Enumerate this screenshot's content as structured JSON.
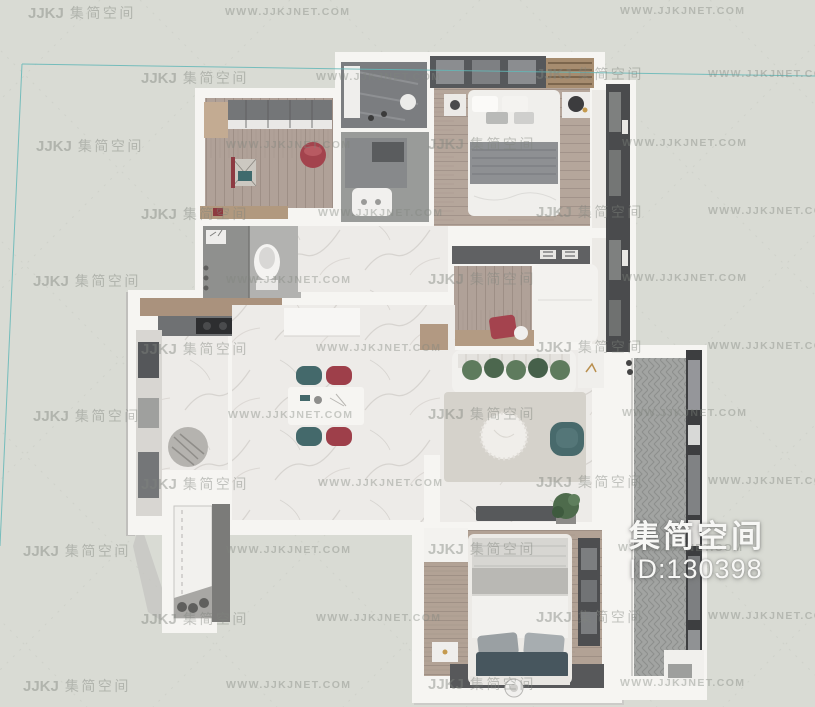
{
  "overlay": {
    "title": "集简空间",
    "id_label": "ID:130398"
  },
  "watermarks": {
    "logo": "JJKJ",
    "brand": "集简空间",
    "url": "WWW.JJKJNET.COM",
    "items": [
      {
        "type": "brand",
        "x": 28,
        "y": 3
      },
      {
        "type": "url",
        "x": 225,
        "y": 6
      },
      {
        "type": "url",
        "x": 620,
        "y": 5
      },
      {
        "type": "brand",
        "x": 141,
        "y": 68
      },
      {
        "type": "url",
        "x": 316,
        "y": 71
      },
      {
        "type": "brand",
        "x": 536,
        "y": 64
      },
      {
        "type": "url",
        "x": 708,
        "y": 68
      },
      {
        "type": "brand",
        "x": 36,
        "y": 136
      },
      {
        "type": "url",
        "x": 226,
        "y": 139
      },
      {
        "type": "brand",
        "x": 428,
        "y": 134
      },
      {
        "type": "url",
        "x": 622,
        "y": 137
      },
      {
        "type": "brand",
        "x": 141,
        "y": 204
      },
      {
        "type": "url",
        "x": 318,
        "y": 207
      },
      {
        "type": "brand",
        "x": 536,
        "y": 202
      },
      {
        "type": "url",
        "x": 708,
        "y": 205
      },
      {
        "type": "brand",
        "x": 33,
        "y": 271
      },
      {
        "type": "url",
        "x": 226,
        "y": 274
      },
      {
        "type": "brand",
        "x": 428,
        "y": 269
      },
      {
        "type": "url",
        "x": 622,
        "y": 272
      },
      {
        "type": "brand",
        "x": 141,
        "y": 339
      },
      {
        "type": "url",
        "x": 316,
        "y": 342
      },
      {
        "type": "brand",
        "x": 536,
        "y": 337
      },
      {
        "type": "url",
        "x": 708,
        "y": 340
      },
      {
        "type": "brand",
        "x": 33,
        "y": 406
      },
      {
        "type": "url",
        "x": 228,
        "y": 409
      },
      {
        "type": "brand",
        "x": 428,
        "y": 404
      },
      {
        "type": "url",
        "x": 622,
        "y": 407
      },
      {
        "type": "brand",
        "x": 141,
        "y": 474
      },
      {
        "type": "url",
        "x": 318,
        "y": 477
      },
      {
        "type": "brand",
        "x": 536,
        "y": 472
      },
      {
        "type": "url",
        "x": 708,
        "y": 475
      },
      {
        "type": "brand",
        "x": 23,
        "y": 541
      },
      {
        "type": "url",
        "x": 226,
        "y": 544
      },
      {
        "type": "brand",
        "x": 428,
        "y": 539
      },
      {
        "type": "url",
        "x": 618,
        "y": 542
      },
      {
        "type": "brand",
        "x": 141,
        "y": 609
      },
      {
        "type": "url",
        "x": 316,
        "y": 612
      },
      {
        "type": "brand",
        "x": 536,
        "y": 607
      },
      {
        "type": "url",
        "x": 708,
        "y": 610
      },
      {
        "type": "brand",
        "x": 23,
        "y": 676
      },
      {
        "type": "url",
        "x": 226,
        "y": 679
      },
      {
        "type": "brand",
        "x": 428,
        "y": 674
      },
      {
        "type": "url",
        "x": 620,
        "y": 677
      }
    ]
  },
  "colors": {
    "background": "#d9dbd4",
    "boundary_cyan": "#63b7b7",
    "wall_white": "#f6f5f2",
    "accent_red": "#a4434e",
    "accent_teal": "#456a6b",
    "plant_green": "#4e6b4c",
    "watermark_gray": "#80857e",
    "overlay_text": "#f7f7f5"
  }
}
